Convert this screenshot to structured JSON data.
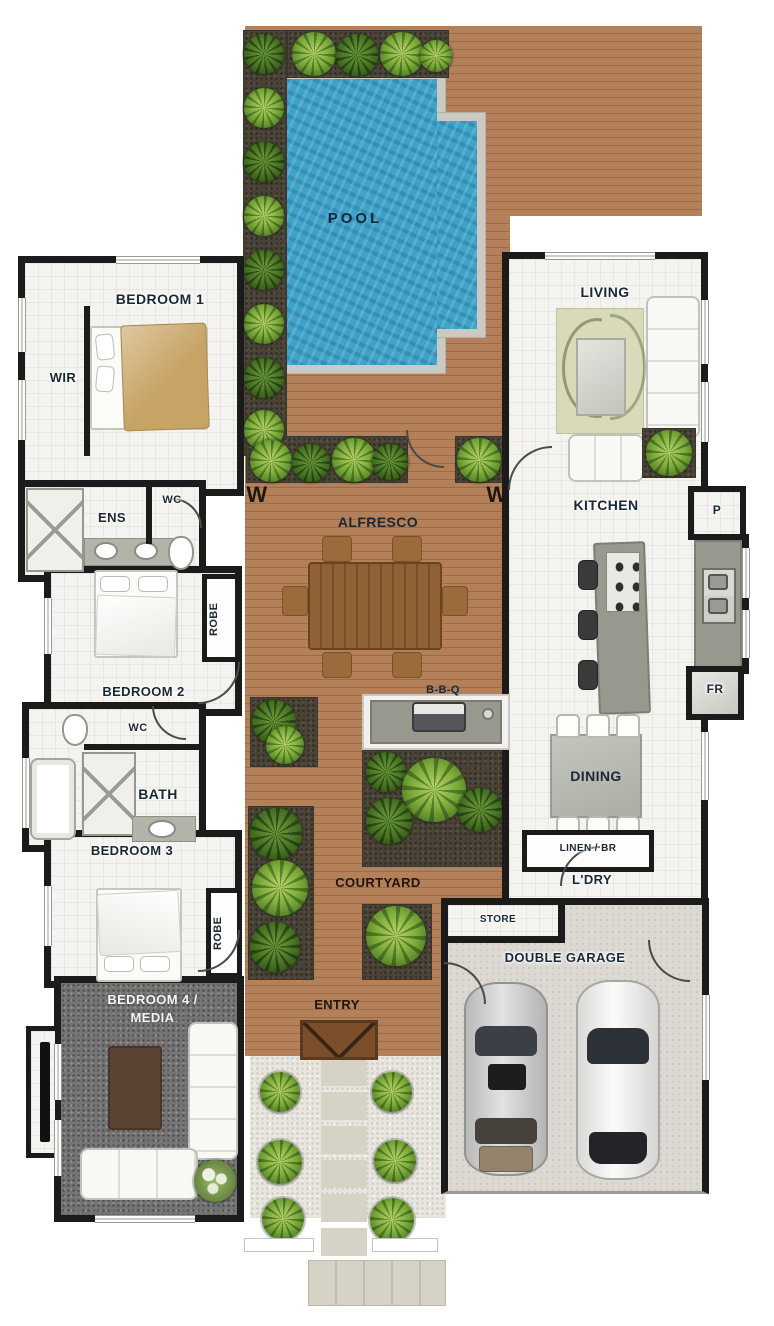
{
  "labels": {
    "pool": "POOL",
    "bedroom1": "BEDROOM 1",
    "wir": "WIR",
    "ens": "ENS",
    "wc_ens": "WC",
    "bedroom2": "BEDROOM 2",
    "robe_2": "ROBE",
    "wc_hall": "WC",
    "bath": "BATH",
    "bedroom3": "BEDROOM 3",
    "robe_3": "ROBE",
    "bedroom4_line1": "BEDROOM 4 /",
    "bedroom4_line2": "MEDIA",
    "living": "LIVING",
    "kitchen": "KITCHEN",
    "pantry": "P",
    "fridge": "FR",
    "alfresco": "ALFRESCO",
    "bbq": "B-B-Q",
    "dining": "DINING",
    "linen": "LINEN / BR",
    "laundry": "L'DRY",
    "courtyard": "COURTYARD",
    "entry": "ENTRY",
    "store": "STORE",
    "garage": "DOUBLE GARAGE",
    "window_w_left": "W",
    "window_w_right": "W"
  },
  "colors": {
    "wall": "#1b1b1b",
    "deck_wood": "#b3805a",
    "pool_water": "#3fa2c9",
    "pool_coping": "#cac9c2",
    "interior_floor": "#f5f3ef",
    "garden_bed": "#4a4336",
    "plant_green": "#7fae3c",
    "media_carpet": "#747474",
    "garage_floor": "#dcd9d3",
    "gravel": "#e8e5df",
    "label_text": "#1a2836",
    "label_text_light": "#f5f5f2"
  }
}
